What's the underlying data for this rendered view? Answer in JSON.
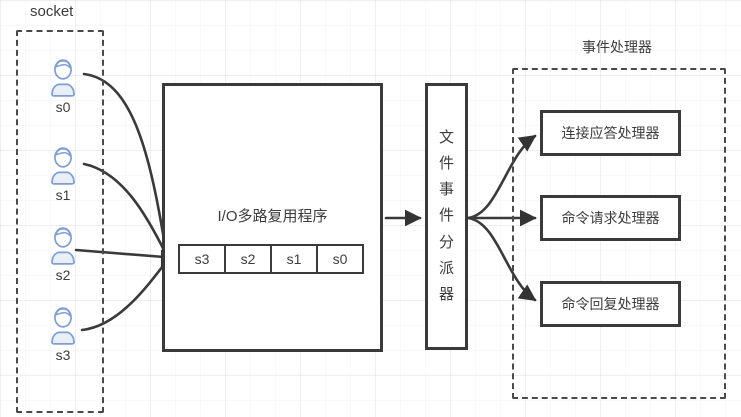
{
  "diagram": {
    "colors": {
      "stroke": "#3a3a3a",
      "client_icon": "#7d9ed8"
    },
    "socket_group": {
      "label": "socket",
      "clients": [
        "s0",
        "s1",
        "s2",
        "s3"
      ]
    },
    "multiplexer": {
      "label": "I/O多路复用程序",
      "queue": [
        "s3",
        "s2",
        "s1",
        "s0"
      ]
    },
    "dispatcher": {
      "label": "文件事件分派器"
    },
    "handler_group": {
      "label": "事件处理器",
      "handlers": [
        "连接应答处理器",
        "命令请求处理器",
        "命令回复处理器"
      ]
    }
  }
}
